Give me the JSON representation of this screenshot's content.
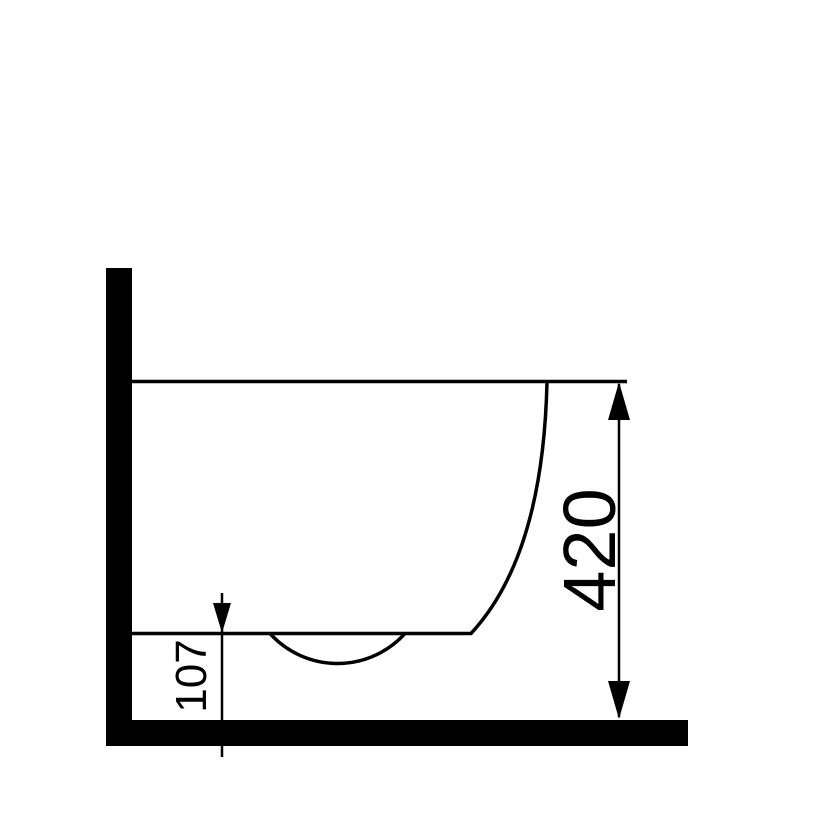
{
  "drawing": {
    "kind": "technical-dimension-side-elevation",
    "subject": "wall-hung-sanitary-fixture-profile",
    "colors": {
      "background": "#ffffff",
      "ink": "#000000"
    },
    "dimensions": [
      {
        "id": "fixture-top-height-above-floor",
        "label": "420",
        "orientation": "vertical"
      },
      {
        "id": "fixture-underside-clearance",
        "label": "107",
        "orientation": "vertical"
      }
    ]
  }
}
